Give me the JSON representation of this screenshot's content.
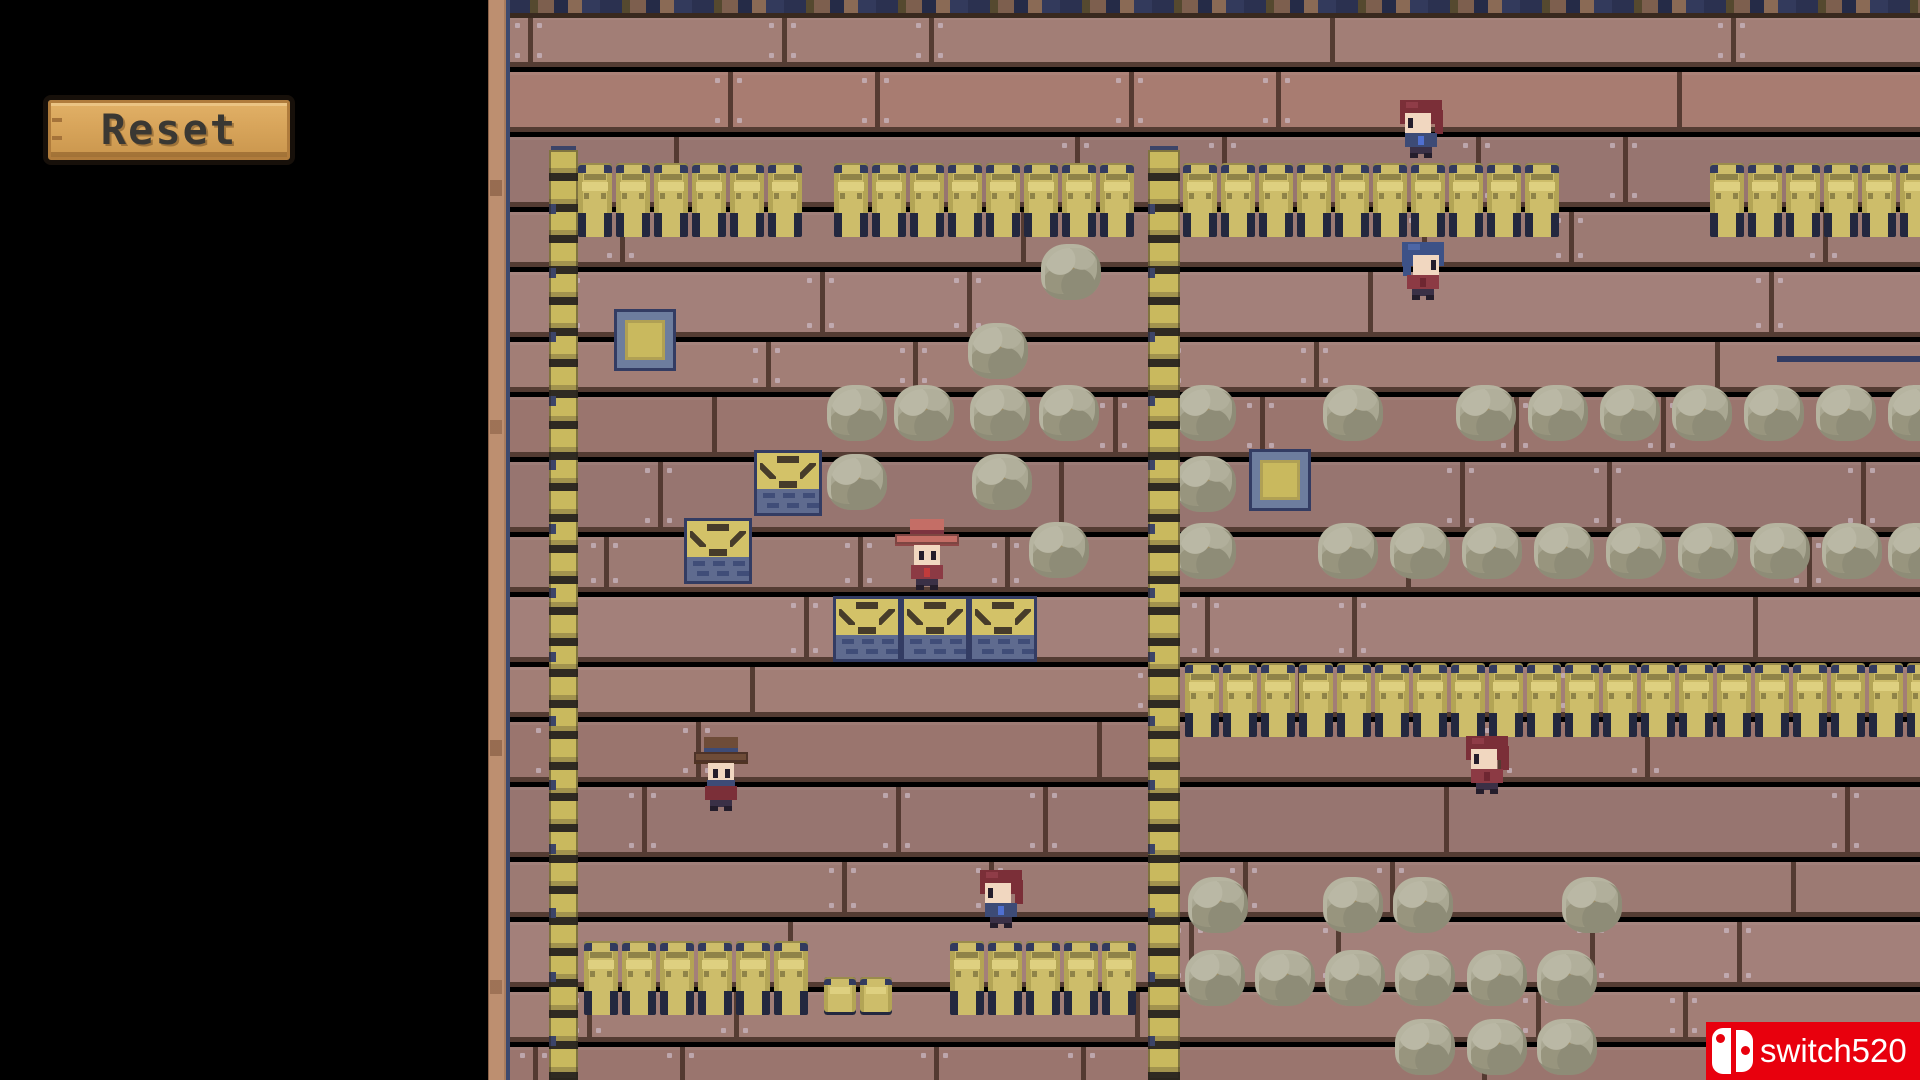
{
  "ui": {
    "reset_label": "Reset"
  },
  "watermark": {
    "text": "switch520",
    "bg_color": "#e8000d",
    "icon": "nintendo-switch-icon"
  },
  "palette": {
    "floor": "#9c7a73",
    "floor_seam": "#543c33",
    "barrel": "#cdbd6a",
    "ladder": "#c9b95e",
    "rock": "#a9a792",
    "crate_top": "#d3c268",
    "crate_front": "#5f6b8f",
    "outline_navy": "#333c63",
    "target_fill": "#c9b95e",
    "target_border": "#6d7d9e",
    "post": "#bd8f70",
    "watermark_red": "#e8000d"
  },
  "board": {
    "ladders": [
      {
        "x": 549,
        "y": 150,
        "w": 29,
        "h": 930
      },
      {
        "x": 1148,
        "y": 150,
        "w": 32,
        "h": 930
      }
    ],
    "barrel_runs": [
      {
        "x": 578,
        "y": 163,
        "count": 6
      },
      {
        "x": 834,
        "y": 163,
        "count": 8
      },
      {
        "x": 1183,
        "y": 163,
        "count": 10
      },
      {
        "x": 1710,
        "y": 163,
        "count": 6
      },
      {
        "x": 1185,
        "y": 663,
        "count": 20
      },
      {
        "x": 584,
        "y": 941,
        "count": 6
      },
      {
        "x": 950,
        "y": 941,
        "count": 5
      }
    ],
    "kegs": [
      {
        "x": 824,
        "y": 977
      },
      {
        "x": 860,
        "y": 977
      }
    ],
    "targets": [
      {
        "x": 617,
        "y": 312
      },
      {
        "x": 1252,
        "y": 452
      }
    ],
    "crates": [
      {
        "x": 754,
        "y": 450
      },
      {
        "x": 684,
        "y": 518
      },
      {
        "x": 833,
        "y": 596
      },
      {
        "x": 901,
        "y": 596
      },
      {
        "x": 969,
        "y": 596
      }
    ],
    "rocks": [
      {
        "x": 1071,
        "y": 272
      },
      {
        "x": 998,
        "y": 351
      },
      {
        "x": 857,
        "y": 413
      },
      {
        "x": 924,
        "y": 413
      },
      {
        "x": 1000,
        "y": 413
      },
      {
        "x": 1069,
        "y": 413
      },
      {
        "x": 857,
        "y": 482
      },
      {
        "x": 1002,
        "y": 482
      },
      {
        "x": 1059,
        "y": 550
      },
      {
        "x": 1206,
        "y": 413
      },
      {
        "x": 1353,
        "y": 413
      },
      {
        "x": 1486,
        "y": 413
      },
      {
        "x": 1558,
        "y": 413
      },
      {
        "x": 1630,
        "y": 413
      },
      {
        "x": 1702,
        "y": 413
      },
      {
        "x": 1774,
        "y": 413
      },
      {
        "x": 1846,
        "y": 413
      },
      {
        "x": 1918,
        "y": 413
      },
      {
        "x": 1206,
        "y": 484
      },
      {
        "x": 1206,
        "y": 551
      },
      {
        "x": 1348,
        "y": 551
      },
      {
        "x": 1420,
        "y": 551
      },
      {
        "x": 1492,
        "y": 551
      },
      {
        "x": 1564,
        "y": 551
      },
      {
        "x": 1636,
        "y": 551
      },
      {
        "x": 1708,
        "y": 551
      },
      {
        "x": 1780,
        "y": 551
      },
      {
        "x": 1852,
        "y": 551
      },
      {
        "x": 1918,
        "y": 551
      },
      {
        "x": 1218,
        "y": 905
      },
      {
        "x": 1353,
        "y": 905
      },
      {
        "x": 1423,
        "y": 905
      },
      {
        "x": 1592,
        "y": 905
      },
      {
        "x": 1215,
        "y": 978
      },
      {
        "x": 1285,
        "y": 978
      },
      {
        "x": 1355,
        "y": 978
      },
      {
        "x": 1425,
        "y": 978
      },
      {
        "x": 1497,
        "y": 978
      },
      {
        "x": 1567,
        "y": 978
      },
      {
        "x": 1425,
        "y": 1047
      },
      {
        "x": 1497,
        "y": 1047
      },
      {
        "x": 1567,
        "y": 1047
      }
    ],
    "characters": [
      {
        "x": 1398,
        "y": 100,
        "variant": "navy",
        "facing": "left"
      },
      {
        "x": 1400,
        "y": 242,
        "variant": "bluehair",
        "facing": "right"
      },
      {
        "x": 894,
        "y": 518,
        "variant": "hat_salmon",
        "facing": "down"
      },
      {
        "x": 693,
        "y": 736,
        "variant": "hat_brown",
        "facing": "down"
      },
      {
        "x": 978,
        "y": 870,
        "variant": "navy",
        "facing": "left"
      },
      {
        "x": 1464,
        "y": 736,
        "variant": "maroon",
        "facing": "left"
      }
    ],
    "navy_line": {
      "x": 1777,
      "y": 356,
      "w": 143,
      "h": 6
    }
  },
  "sprites": {
    "character_variants": {
      "navy": {
        "hair": "#7b2f38",
        "hair_hi": "#8f3c47",
        "shirt": "#3d4b76",
        "accent": "#4f6fd0",
        "pants": "#3a3046",
        "skin": "#f1d7c0",
        "eye": "#241d2b"
      },
      "maroon": {
        "hair": "#7b2f38",
        "hair_hi": "#8f3c47",
        "shirt": "#8c3a44",
        "accent": "#6e2631",
        "pants": "#3a3046",
        "skin": "#f1d7c0",
        "eye": "#241d2b"
      },
      "bluehair": {
        "hair": "#3d5287",
        "hair_hi": "#4d66a5",
        "shirt": "#8c3a44",
        "accent": "#6e2631",
        "pants": "#3a3046",
        "skin": "#f1d7c0",
        "eye": "#241d2b"
      },
      "hat_salmon": {
        "hat": "#c46e66",
        "hat_dark": "#8e4747",
        "band": "#7c3340",
        "brim": 64,
        "shirt": "#8c3a44",
        "accent": "#c23b3b",
        "pants": "#3a3046",
        "skin": "#f1d7c0",
        "eye": "#241d2b"
      },
      "hat_brown": {
        "hat": "#6e4c38",
        "hat_dark": "#503423",
        "band": "#3d4b76",
        "brim": 54,
        "bandana": "#3d4b76",
        "shirt": "#7b2f38",
        "pants": "#3a3046",
        "skin": "#f1d7c0",
        "eye": "#241d2b"
      }
    }
  }
}
